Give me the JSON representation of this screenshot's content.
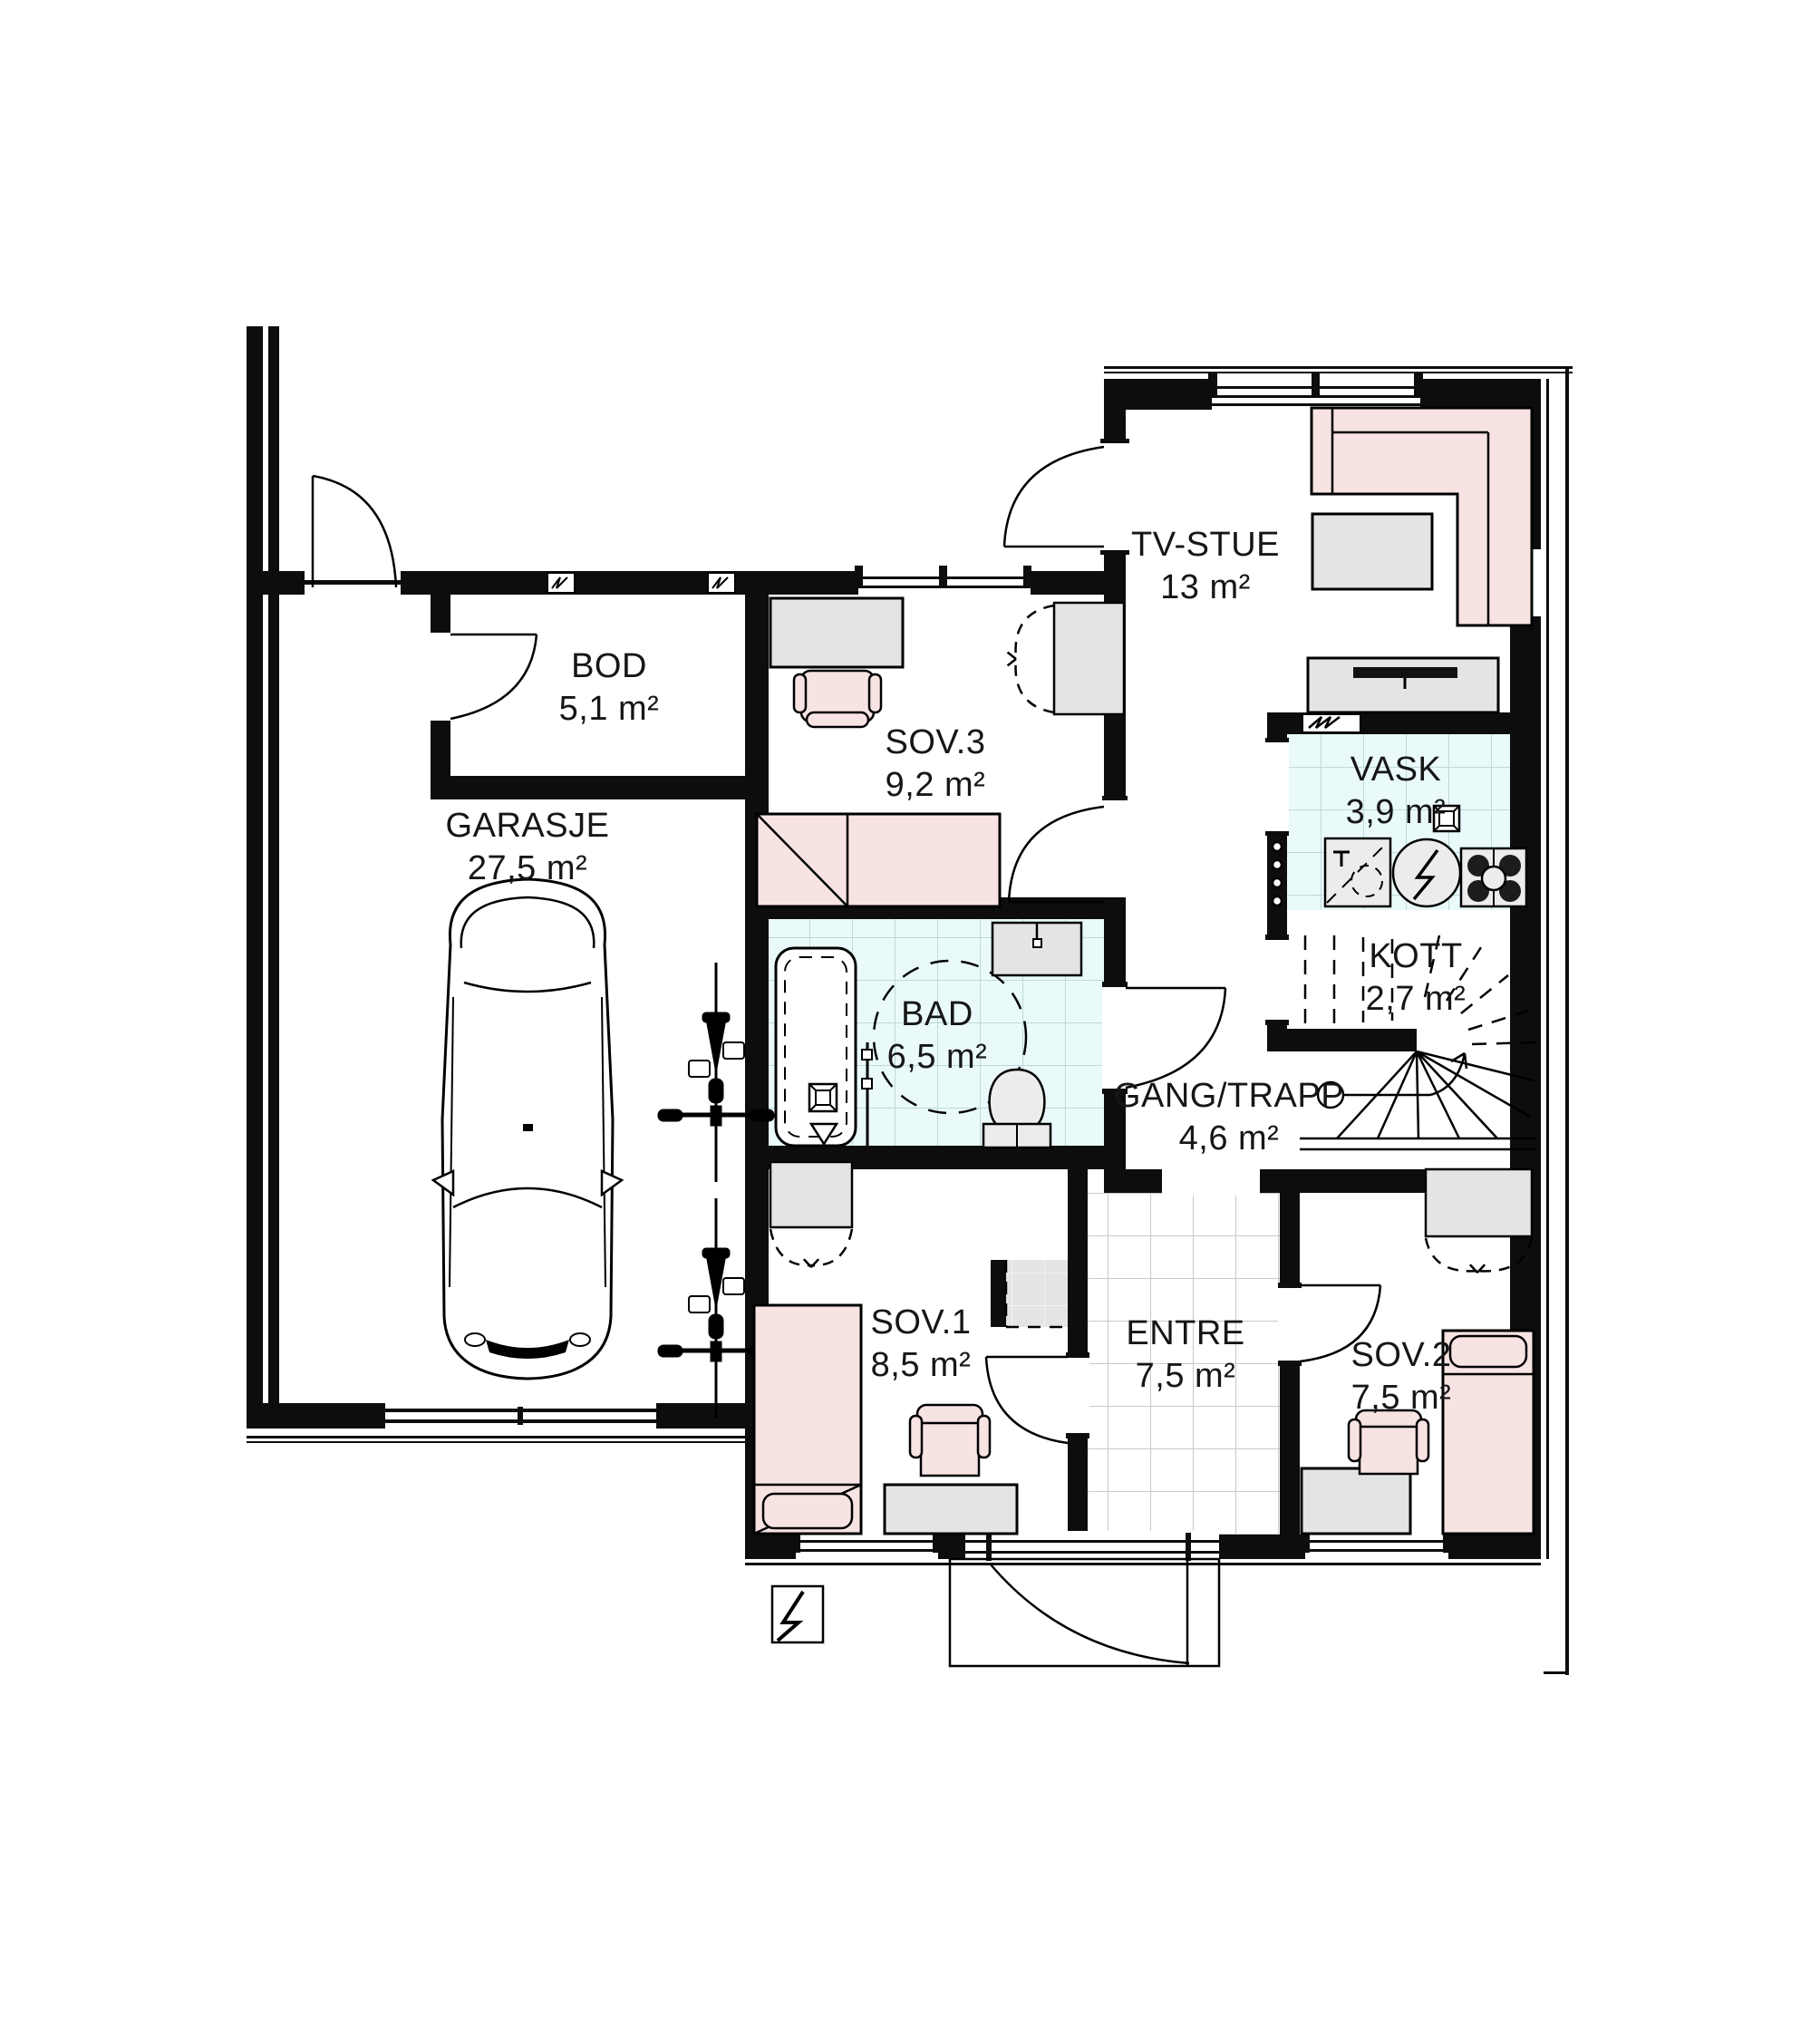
{
  "plan": {
    "type": "architectural-floor-plan",
    "rooms": {
      "bod": {
        "name": "BOD",
        "area": "5,1 m²"
      },
      "garasje": {
        "name": "GARASJE",
        "area": "27,5 m²"
      },
      "sov3": {
        "name": "SOV.3",
        "area": "9,2 m²"
      },
      "tvstue": {
        "name": "TV-STUE",
        "area": "13 m²"
      },
      "vask": {
        "name": "VASK",
        "area": "3,9 m²"
      },
      "kott": {
        "name": "KOTT",
        "area": "2,7 m²"
      },
      "bad": {
        "name": "BAD",
        "area": "6,5 m²"
      },
      "gang": {
        "name": "GANG/TRAPP",
        "area": "4,6 m²"
      },
      "sov1": {
        "name": "SOV.1",
        "area": "8,5 m²"
      },
      "entre": {
        "name": "ENTRE",
        "area": "7,5 m²"
      },
      "sov2": {
        "name": "SOV.2",
        "area": "7,5 m²"
      }
    },
    "colors": {
      "wall": "#0d0d0d",
      "furniture_gray": "#e4e4e4",
      "furniture_pink": "#f8e3e3",
      "wet_room_floor": "#eafafa",
      "wet_tile_line": "#bfd9d9",
      "entre_tile_line": "#c9c9c9"
    },
    "symbols": [
      "car",
      "bicycle",
      "bathtub",
      "shower-screen",
      "toilet",
      "sink",
      "floor-drain",
      "washing-machine",
      "stove",
      "turning-circle",
      "stair-winder",
      "stair-direction-arrow",
      "door-swing",
      "wardrobe-dashed-doors",
      "electrical-lightning",
      "wall-vent",
      "window"
    ]
  }
}
